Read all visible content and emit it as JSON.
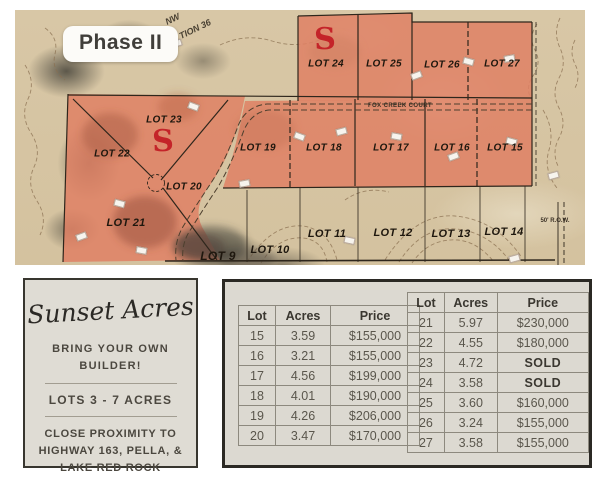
{
  "map": {
    "phase_label": "Phase II",
    "corner_label_top": "NW",
    "corner_label_bottom": "TION 36",
    "road_label": "FOX CREEK COURT",
    "row_label": "50' R.O.W.",
    "sold_letter": "S",
    "colors": {
      "lot_fill": "#df8064",
      "sold_red": "#c42429",
      "terrain_tan": "#d8c7a6"
    },
    "lots": [
      {
        "label": "LOT 24",
        "x": 311,
        "y": 54,
        "size": 10
      },
      {
        "label": "LOT 25",
        "x": 369,
        "y": 54,
        "size": 10
      },
      {
        "label": "LOT 26",
        "x": 427,
        "y": 55,
        "size": 10
      },
      {
        "label": "LOT 27",
        "x": 487,
        "y": 54,
        "size": 10
      },
      {
        "label": "LOT 23",
        "x": 149,
        "y": 110,
        "size": 10
      },
      {
        "label": "LOT 22",
        "x": 97,
        "y": 144,
        "size": 10
      },
      {
        "label": "LOT 19",
        "x": 243,
        "y": 138,
        "size": 10
      },
      {
        "label": "LOT 18",
        "x": 309,
        "y": 138,
        "size": 10
      },
      {
        "label": "LOT 17",
        "x": 376,
        "y": 138,
        "size": 10
      },
      {
        "label": "LOT 16",
        "x": 437,
        "y": 138,
        "size": 10
      },
      {
        "label": "LOT 15",
        "x": 490,
        "y": 138,
        "size": 10
      },
      {
        "label": "LOT 20",
        "x": 169,
        "y": 177,
        "size": 10
      },
      {
        "label": "LOT 21",
        "x": 111,
        "y": 213,
        "size": 11
      },
      {
        "label": "LOT 9",
        "x": 203,
        "y": 246,
        "size": 12
      },
      {
        "label": "LOT 10",
        "x": 255,
        "y": 240,
        "size": 11
      },
      {
        "label": "LOT 11",
        "x": 312,
        "y": 224,
        "size": 11
      },
      {
        "label": "LOT 12",
        "x": 378,
        "y": 223,
        "size": 11
      },
      {
        "label": "LOT 13",
        "x": 436,
        "y": 224,
        "size": 11
      },
      {
        "label": "LOT 14",
        "x": 489,
        "y": 222,
        "size": 11
      }
    ],
    "sold_markers": [
      {
        "x": 310,
        "y": 30
      },
      {
        "x": 148,
        "y": 132
      }
    ]
  },
  "info_panel": {
    "brand": "Sunset Acres",
    "tagline_1": "BRING YOUR OWN BUILDER!",
    "tagline_2": "LOTS 3 - 7 ACRES",
    "tagline_3": "CLOSE PROXIMITY TO HIGHWAY 163, PELLA, & LAKE RED ROCK"
  },
  "price_tables": [
    {
      "headers": [
        "Lot",
        "Acres",
        "Price"
      ],
      "rows": [
        [
          "15",
          "3.59",
          "$155,000"
        ],
        [
          "16",
          "3.21",
          "$155,000"
        ],
        [
          "17",
          "4.56",
          "$199,000"
        ],
        [
          "18",
          "4.01",
          "$190,000"
        ],
        [
          "19",
          "4.26",
          "$206,000"
        ],
        [
          "20",
          "3.47",
          "$170,000"
        ]
      ]
    },
    {
      "headers": [
        "Lot",
        "Acres",
        "Price"
      ],
      "rows": [
        [
          "21",
          "5.97",
          "$230,000"
        ],
        [
          "22",
          "4.55",
          "$180,000"
        ],
        [
          "23",
          "4.72",
          "SOLD"
        ],
        [
          "24",
          "3.58",
          "SOLD"
        ],
        [
          "25",
          "3.60",
          "$160,000"
        ],
        [
          "26",
          "3.24",
          "$155,000"
        ],
        [
          "27",
          "3.58",
          "$155,000"
        ]
      ]
    }
  ]
}
